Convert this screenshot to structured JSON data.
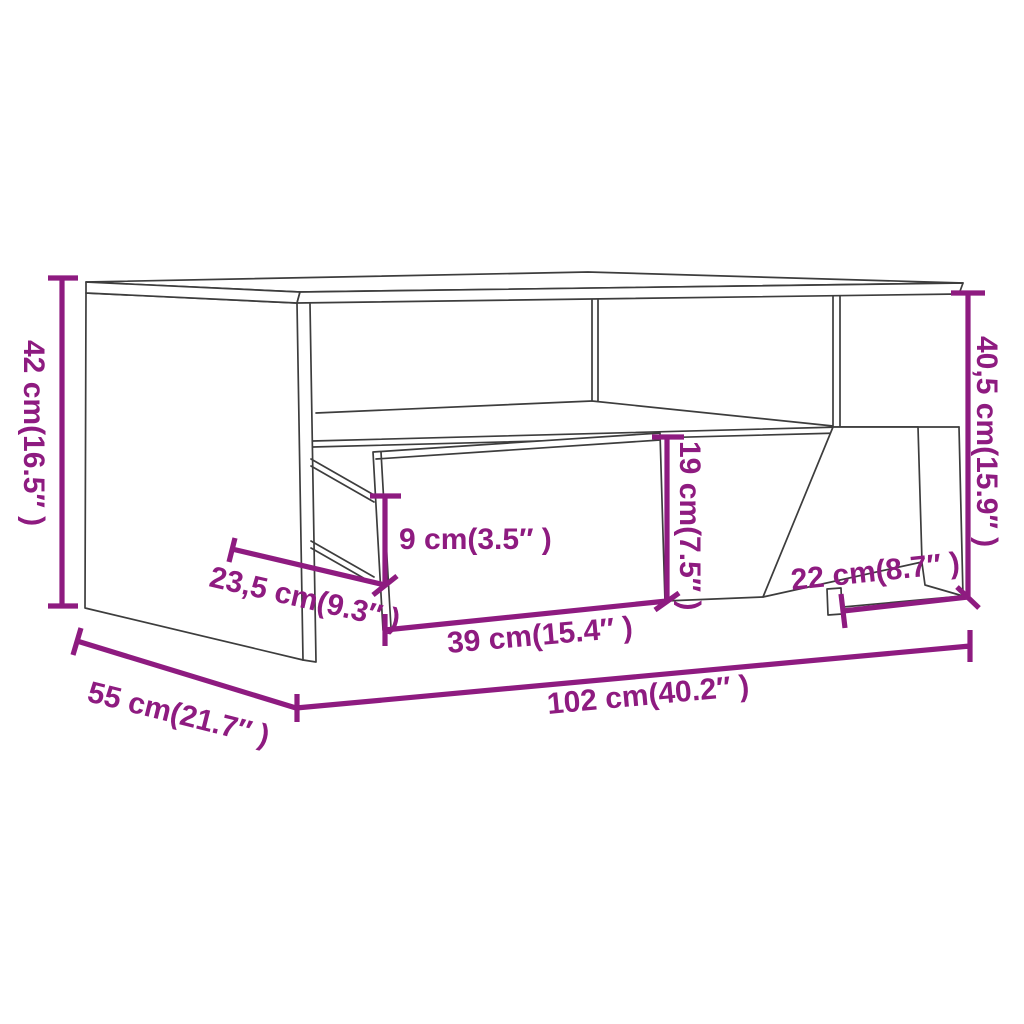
{
  "diagram": {
    "type": "furniture-dimension-drawing",
    "subject": "coffee table with open compartment and pulled-out drawer"
  },
  "colors": {
    "background": "#ffffff",
    "outline": "#3d3d3d",
    "dimension": "#8e1b80"
  },
  "dimensions": {
    "height": "42 cm(16.5″ )",
    "depth": "55 cm(21.7″ )",
    "width": "102 cm(40.2″ )",
    "drawer_extension": "23,5 cm(9.3″ )",
    "drawer_side_height": "9 cm(3.5″ )",
    "drawer_front_width": "39 cm(15.4″ )",
    "opening_height": "19 cm(7.5″ )",
    "right_opening_width": "22 cm(8.7″ )",
    "inner_height": "40,5 cm(15.9″ )"
  }
}
